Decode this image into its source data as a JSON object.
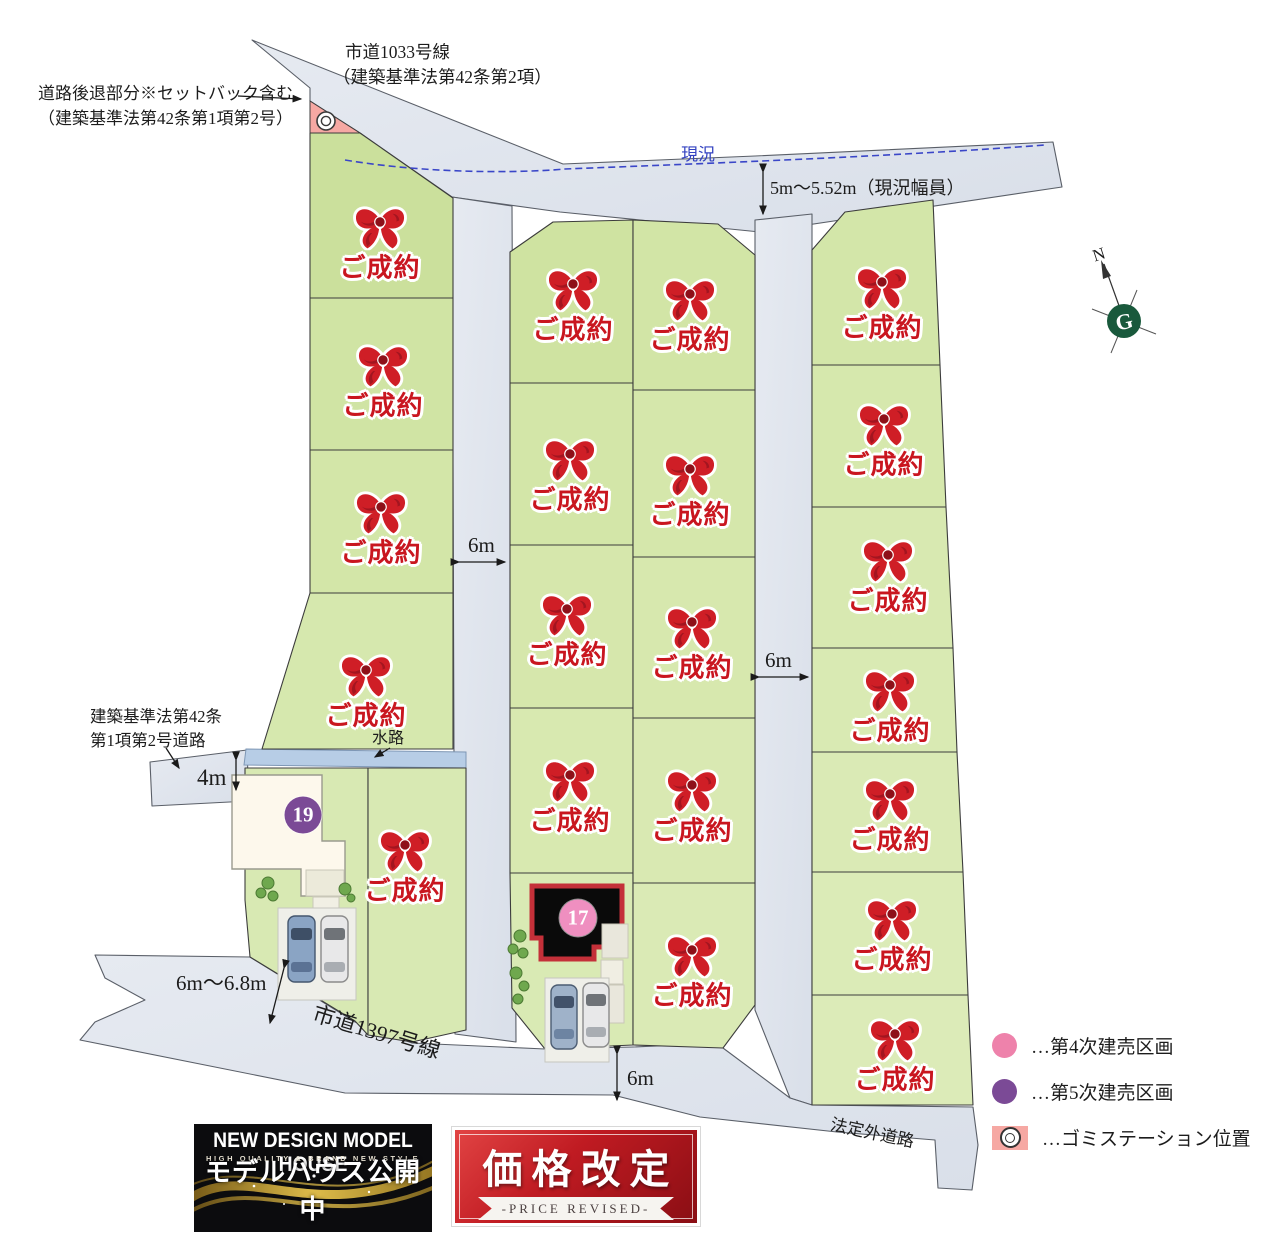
{
  "map": {
    "labels": {
      "setback_line1": "道路後退部分※セットバック含む",
      "setback_line2": "（建築基準法第42条第1項第2号）",
      "road_top_line1": "市道1033号線",
      "road_top_line2": "（建築基準法第42条第2項）",
      "genkyo": "現況",
      "genkyo_width": "5m〜5.52m（現況幅員）",
      "law42_line1": "建築基準法第42条",
      "law42_line2": "第1項第2号道路",
      "waterway": "水路",
      "road_1397": "市道1397号線",
      "road_hoteigai": "法定外道路",
      "north": "N",
      "dim_4m": "4m",
      "dim_6m": "6m",
      "dim_6to68": "6m〜6.8m"
    },
    "sold_label": "ご成約",
    "sold_markers": [
      [
        380,
        240
      ],
      [
        383,
        378
      ],
      [
        381,
        525
      ],
      [
        366,
        688
      ],
      [
        405,
        863
      ],
      [
        573,
        302
      ],
      [
        570,
        472
      ],
      [
        567,
        627
      ],
      [
        570,
        793
      ],
      [
        690,
        312
      ],
      [
        690,
        487
      ],
      [
        692,
        640
      ],
      [
        692,
        803
      ],
      [
        692,
        968
      ],
      [
        882,
        300
      ],
      [
        884,
        437
      ],
      [
        888,
        573
      ],
      [
        890,
        703
      ],
      [
        890,
        812
      ],
      [
        892,
        932
      ],
      [
        895,
        1052
      ]
    ],
    "numbered_lots": [
      {
        "no": "19",
        "x": 303,
        "y": 815,
        "color": "#7b4a96"
      },
      {
        "no": "17",
        "x": 578,
        "y": 918,
        "color": "#ef8fc0"
      }
    ]
  },
  "legend": {
    "items": [
      {
        "type": "circle",
        "color": "#ee82ab",
        "label": "…第4次建売区画"
      },
      {
        "type": "circle",
        "color": "#7b4a96",
        "label": "…第5次建売区画"
      },
      {
        "type": "gomi",
        "color": "#f6a8a3",
        "label": "…ゴミステーション位置"
      }
    ]
  },
  "badges": {
    "model_house": {
      "title": "NEW DESIGN MODEL HOUSE",
      "subtitle": "HIGH QUALITY & BRAND NEW STYLE",
      "caption": "モデルハウス公開中"
    },
    "price": {
      "title": "価格改定",
      "subtitle": "-PRICE REVISED-"
    }
  },
  "colors": {
    "lot_green": "#d4e6aa",
    "road_gray": "#e1e5ed",
    "sold_red": "#c9161f",
    "setback_pink": "#f6a8a3",
    "waterway_blue": "#b7cde6",
    "compass_green": "#19593c"
  }
}
